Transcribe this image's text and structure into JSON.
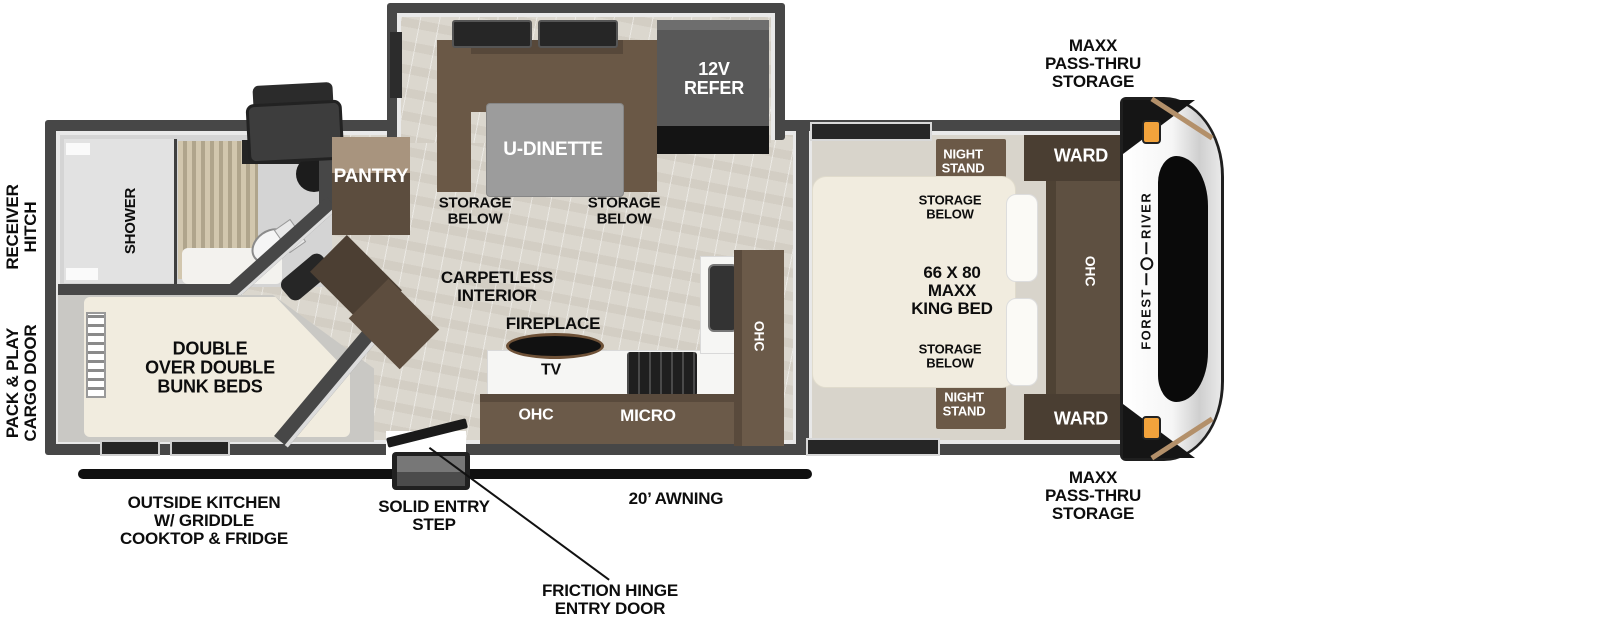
{
  "title": "Forest River travel trailer floorplan",
  "colors": {
    "wall": "#474747",
    "floor_wood": "#dbd7ce",
    "cabinet_brown": "#6b5a49",
    "cabinet_dark_brown": "#4c3f33",
    "bed_cream": "#f1ecdf",
    "marker_orange": "#f2a33c",
    "label_dark": "#0d0d0d",
    "label_light": "#ffffff"
  },
  "exterior": {
    "receiver_hitch": "RECEIVER\nHITCH",
    "cargo_door": "PACK & PLAY\nCARGO DOOR",
    "pass_thru_top": "MAXX\nPASS-THRU\nSTORAGE",
    "pass_thru_bottom": "MAXX\nPASS-THRU\nSTORAGE",
    "outside_kitchen": "OUTSIDE KITCHEN\nW/ GRIDDLE\nCOOKTOP & FRIDGE",
    "entry_step": "SOLID ENTRY\nSTEP",
    "awning": "20’ AWNING",
    "entry_door": "FRICTION HINGE\nENTRY DOOR"
  },
  "brand": {
    "word1": "FOREST",
    "word2": "RIVER"
  },
  "rear_section": {
    "shower": "SHOWER",
    "bunks": "DOUBLE\nOVER DOUBLE\nBUNK BEDS"
  },
  "galley": {
    "pantry": "PANTRY",
    "carpetless": "CARPETLESS\nINTERIOR",
    "fireplace": "FIREPLACE",
    "tv": "TV",
    "ohc_lower": "OHC",
    "micro": "MICRO",
    "ohc_side": "OHC"
  },
  "dinette": {
    "table": "U-DINETTE",
    "refer": "12V\nREFER",
    "storage_left": "STORAGE\nBELOW",
    "storage_right": "STORAGE\nBELOW"
  },
  "bedroom": {
    "night_stand_top": "NIGHT\nSTAND",
    "night_stand_bottom": "NIGHT\nSTAND",
    "storage_top": "STORAGE\nBELOW",
    "storage_bottom": "STORAGE\nBELOW",
    "bed": "66 X 80\nMAXX\nKING BED",
    "ward_top": "WARD",
    "ward_bottom": "WARD",
    "ohc": "OHC"
  }
}
